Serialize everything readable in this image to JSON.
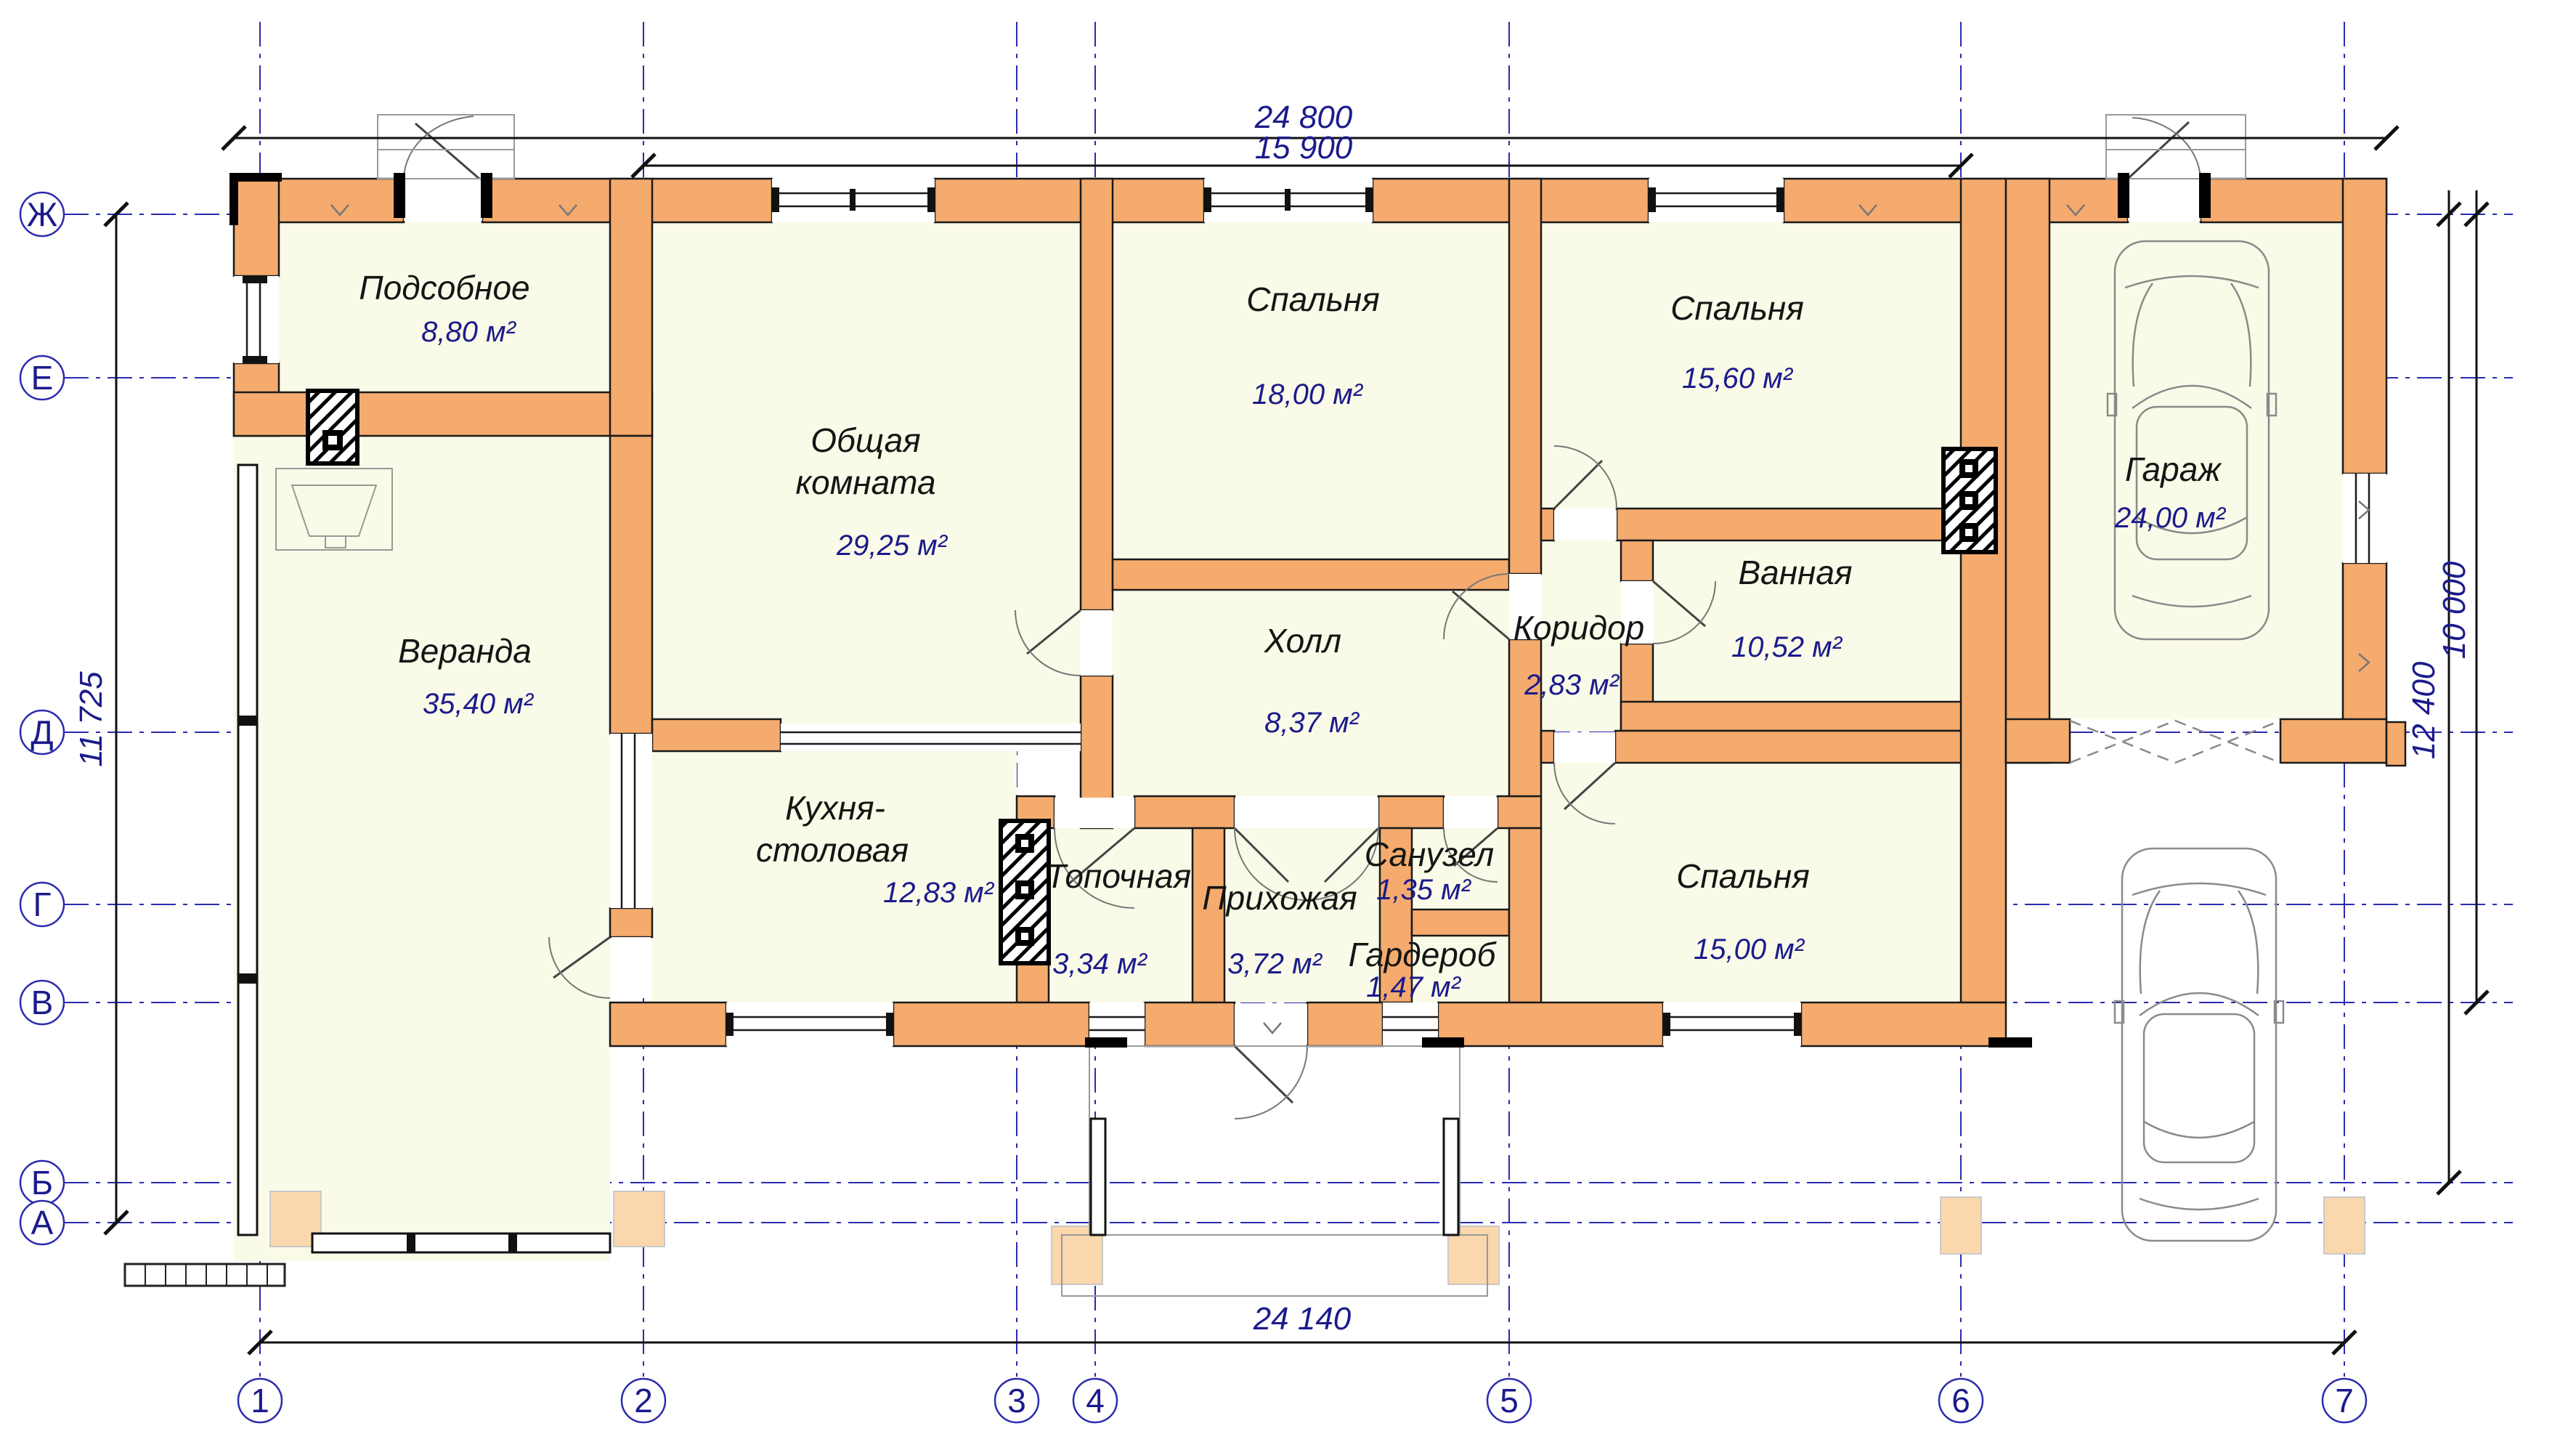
{
  "drawing_type": "floor-plan",
  "rooms": [
    {
      "id": "podsobnoe",
      "name": "Подсобное",
      "area": "8,80 м²"
    },
    {
      "id": "obshchaya",
      "name": "Общая комната",
      "lines": [
        "Общая",
        "комната"
      ],
      "area": "29,25 м²"
    },
    {
      "id": "veranda",
      "name": "Веранда",
      "area": "35,40 м²"
    },
    {
      "id": "kuhnya",
      "name": "Кухня-столовая",
      "lines": [
        "Кухня-",
        "столовая"
      ],
      "area": "12,83 м²"
    },
    {
      "id": "topochnaya",
      "name": "Топочная",
      "area": "3,34 м²"
    },
    {
      "id": "prihozhaya",
      "name": "Прихожая",
      "area": "3,72 м²"
    },
    {
      "id": "sanuzel",
      "name": "Санузел",
      "area": "1,35 м²"
    },
    {
      "id": "garderob",
      "name": "Гардероб",
      "area": "1,47 м²"
    },
    {
      "id": "holl",
      "name": "Холл",
      "area": "8,37 м²"
    },
    {
      "id": "koridor",
      "name": "Коридор",
      "area": "2,83 м²"
    },
    {
      "id": "vannaya",
      "name": "Ванная",
      "area": "10,52 м²"
    },
    {
      "id": "spalnya-1",
      "name": "Спальня",
      "area": "18,00 м²"
    },
    {
      "id": "spalnya-2",
      "name": "Спальня",
      "area": "15,60 м²"
    },
    {
      "id": "spalnya-3",
      "name": "Спальня",
      "area": "15,00 м²"
    },
    {
      "id": "garazh",
      "name": "Гараж",
      "area": "24,00 м²"
    }
  ],
  "dims": {
    "overall_width": "24 800",
    "inner_width": "15 900",
    "bottom_width": "24 140",
    "left_height": "11 725",
    "right_inner": "12 400",
    "right_outer": "10 000"
  },
  "axes": {
    "rows": [
      "Ж",
      "Е",
      "Д",
      "Г",
      "В",
      "Б",
      "А"
    ],
    "cols": [
      "1",
      "2",
      "3",
      "4",
      "5",
      "6",
      "7"
    ]
  },
  "colors": {
    "wall": "#F5AB6E",
    "room_fill": "#FAFAE8",
    "footing_pad": "#FAD7AC",
    "grid_line": "#2B2BB0",
    "accent_text": "#1B1B8C",
    "outline": "#1A1A1A"
  }
}
